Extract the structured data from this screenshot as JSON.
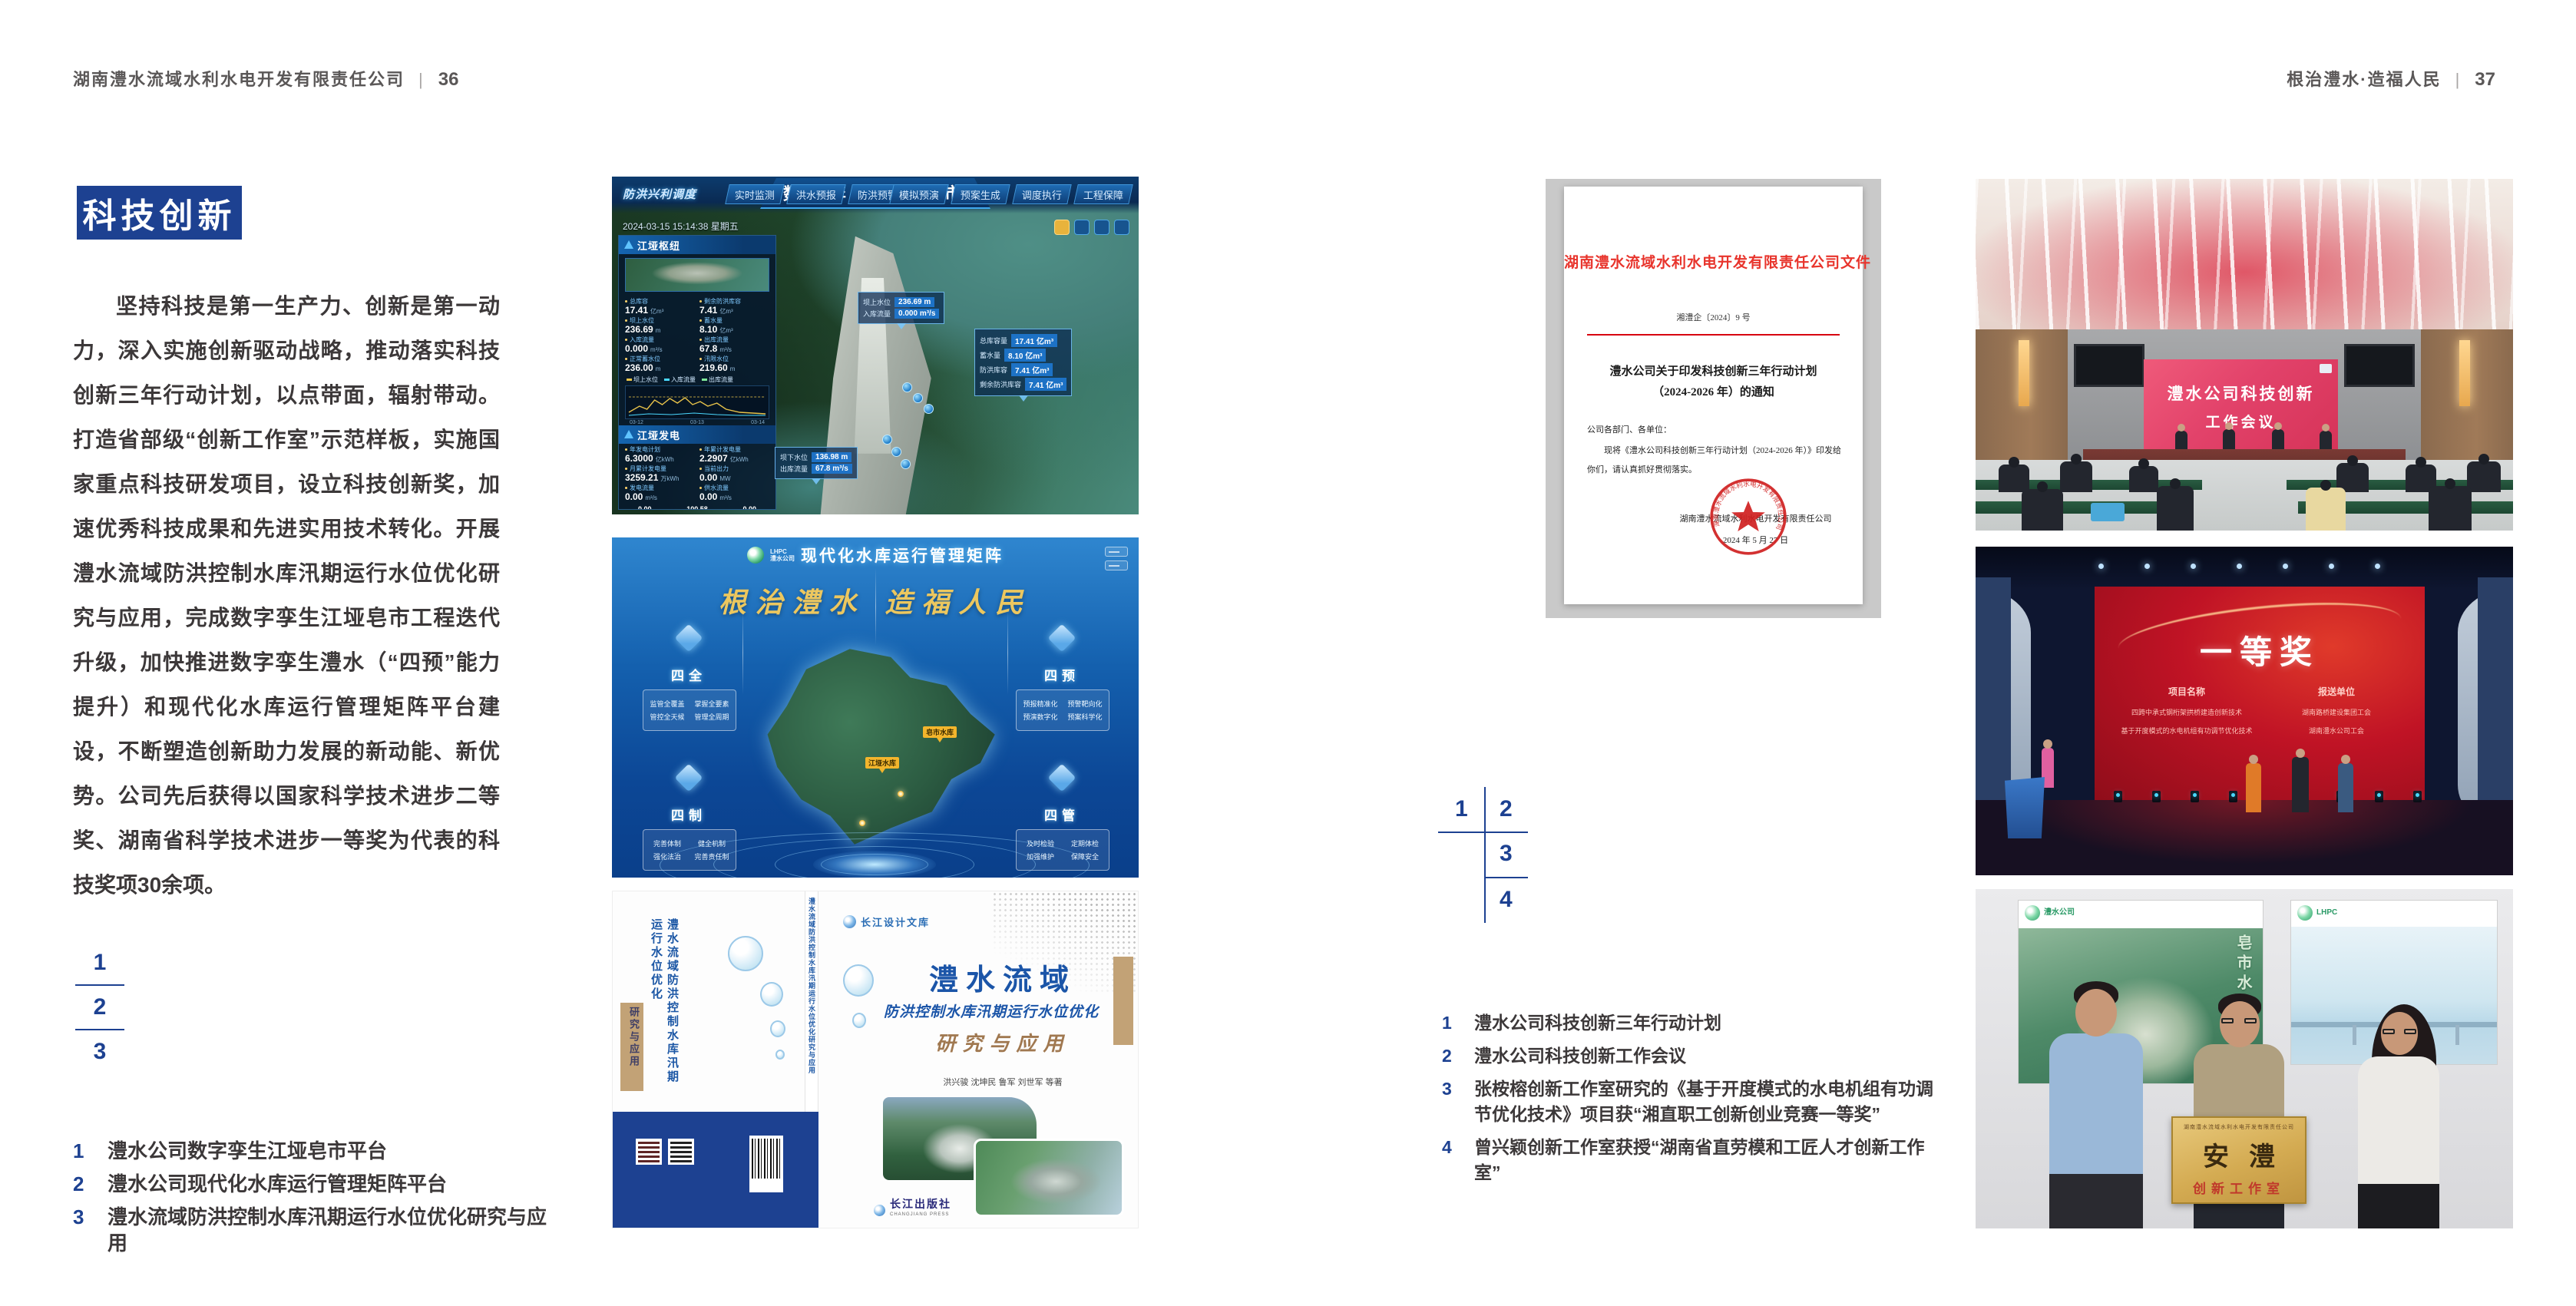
{
  "colors": {
    "brand_blue": "#1d4191",
    "header_gray": "#5a5757",
    "doc_red": "#e60012",
    "book_blue": "#1b55a8",
    "book_tan": "#c2a276",
    "slogan_gold": "#ecc75f",
    "award_red": "#c01325",
    "plaque_gold": "#d4ab52"
  },
  "header_left": {
    "company": "湖南澧水流域水利水电开发有限责任公司",
    "divider": "|",
    "page": "36"
  },
  "header_right": {
    "slogan": "根治澧水·造福人民",
    "divider": "|",
    "page": "37"
  },
  "left": {
    "section_title": "科技创新",
    "paragraph": "坚持科技是第一生产力、创新是第一动力，深入实施创新驱动战略，推动落实科技创新三年行动计划，以点带面，辐射带动。打造省部级“创新工作室”示范样板，实施国家重点科技研发项目，设立科技创新奖，加速优秀科技成果和先进实用技术转化。开展澧水流域防洪控制水库汛期运行水位优化研究与应用，完成数字孪生江垭皂市工程迭代升级，加快推进数字孪生澧水（“四预”能力提升）和现代化水库运行管理矩阵平台建设，不断塑造创新助力发展的新动能、新优势。公司先后获得以国家科学技术进步二等奖、湖南省科学技术进步一等奖为代表的科技奖项30余项。",
    "figure_index": [
      "1",
      "2",
      "3"
    ],
    "captions": [
      {
        "no": "1",
        "text": "澧水公司数字孪生江垭皂市平台"
      },
      {
        "no": "2",
        "text": "澧水公司现代化水库运行管理矩阵平台"
      },
      {
        "no": "3",
        "text": "澧水流域防洪控制水库汛期运行水位优化研究与应用"
      }
    ]
  },
  "right": {
    "figure_index": [
      "1",
      "2",
      "3",
      "4"
    ],
    "captions": [
      {
        "no": "1",
        "text": "澧水公司科技创新三年行动计划"
      },
      {
        "no": "2",
        "text": "澧水公司科技创新工作会议"
      },
      {
        "no": "3",
        "text": "张桉榕创新工作室研究的《基于开度模式的水电机组有功调节优化技术》项目获“湘直职工创新创业竞赛一等奖”"
      },
      {
        "no": "4",
        "text": "曾兴颖创新工作室获授“湖南省直劳模和工匠人才创新工作室”"
      }
    ]
  },
  "figure1": {
    "title": "数字孪生江垭皂市",
    "module_label": "防洪兴利调度",
    "datetime": "2024-03-15 15:14:38 星期五",
    "tabs_left": [
      "实时监测",
      "洪水预报",
      "防洪预警"
    ],
    "tabs_right": [
      "模拟预演",
      "预案生成",
      "调度执行",
      "工程保障"
    ],
    "panel1_title": "江垭枢纽",
    "panel1_stats": [
      {
        "label": "总库容",
        "value": "17.41",
        "unit": "亿m³"
      },
      {
        "label": "剩余防洪库容",
        "value": "7.41",
        "unit": "亿m³"
      },
      {
        "label": "坝上水位",
        "value": "236.69",
        "unit": "m"
      },
      {
        "label": "蓄水量",
        "value": "8.10",
        "unit": "亿m³"
      },
      {
        "label": "入库流量",
        "value": "0.000",
        "unit": "m³/s"
      },
      {
        "label": "出库流量",
        "value": "67.8",
        "unit": "m³/s"
      },
      {
        "label": "正常蓄水位",
        "value": "236.00",
        "unit": "m"
      },
      {
        "label": "汛限水位",
        "value": "219.60",
        "unit": "m"
      }
    ],
    "chart_legend": [
      "坝上水位",
      "入库流量",
      "出库流量"
    ],
    "chart_ticks": [
      "03-12",
      "03-13",
      "03-14"
    ],
    "panel2_title": "江垭发电",
    "panel2_stats": [
      {
        "label": "年发电计划",
        "value": "6.3000",
        "unit": "亿kWh"
      },
      {
        "label": "年累计发电量",
        "value": "2.2907",
        "unit": "亿kWh"
      },
      {
        "label": "月累计发电量",
        "value": "3259.21",
        "unit": "万kWh"
      },
      {
        "label": "当前出力",
        "value": "0.00",
        "unit": "MW"
      },
      {
        "label": "发电流量",
        "value": "0.00",
        "unit": "m³/s"
      },
      {
        "label": "供水流量",
        "value": "0.00",
        "unit": "m³/s"
      }
    ],
    "gauges": [
      {
        "value": "0.00",
        "label": "1#机组"
      },
      {
        "value": "100.58",
        "label": "2#机组"
      },
      {
        "value": "0.00",
        "label": "3#机组"
      }
    ],
    "tagA": [
      {
        "label": "坝上水位",
        "value": "236.69 m"
      },
      {
        "label": "入库流量",
        "value": "0.000 m³/s"
      }
    ],
    "tagB": [
      {
        "label": "总库容量",
        "value": "17.41 亿m³"
      },
      {
        "label": "蓄水量",
        "value": "8.10 亿m³"
      },
      {
        "label": "防洪库容",
        "value": "7.41 亿m³"
      },
      {
        "label": "剩余防洪库容",
        "value": "7.41 亿m³"
      }
    ],
    "tagC": [
      {
        "label": "坝下水位",
        "value": "136.98 m"
      },
      {
        "label": "出库流量",
        "value": "67.8 m³/s"
      }
    ]
  },
  "figure2": {
    "brand_line1": "LHPC",
    "brand_line2": "澧水公司",
    "title": "现代化水库运行管理矩阵",
    "slogan": "根治澧水 造福人民",
    "markers": [
      "皂市水库",
      "江垭水库"
    ],
    "groups": [
      {
        "name": "四全",
        "items": [
          "监管全覆盖",
          "掌握全要素",
          "管控全天候",
          "管理全周期"
        ]
      },
      {
        "name": "四预",
        "items": [
          "预报精准化",
          "预警靶向化",
          "预演数字化",
          "预案科学化"
        ]
      },
      {
        "name": "四制",
        "items": [
          "完善体制",
          "健全机制",
          "强化法治",
          "完善责任制"
        ]
      },
      {
        "name": "四管",
        "items": [
          "及时检验",
          "定期体检",
          "加强维护",
          "保障安全"
        ]
      }
    ]
  },
  "figure3": {
    "series_logo": "长江设计文库",
    "title_main": "澧水流域",
    "title_sub": "防洪控制水库汛期运行水位优化",
    "title_tail": "研究与应用",
    "authors": "洪兴骏  沈坤民  鲁军  刘世军  等著",
    "spine_title": "澧水流域防洪控制水库汛期运行水位优化研究与应用",
    "publisher": "长江出版社",
    "publisher_en": "CHANGJIANG PRESS"
  },
  "document": {
    "header": "湖南澧水流域水利水电开发有限责任公司文件",
    "doc_no": "湘澧企〔2024〕9 号",
    "title_line1": "澧水公司关于印发科技创新三年行动计划",
    "title_line2": "（2024-2026 年）的通知",
    "salutation": "公司各部门、各单位：",
    "body": "现将《澧水公司科技创新三年行动计划（2024-2026 年）》印发给你们，请认真抓好贯彻落实。",
    "signer": "湖南澧水流域水利水电开发有限责任公司",
    "date": "2024 年 5 月 27 日",
    "seal_text": "湖南澧水流域水利水电开发有限责任公司"
  },
  "photo_meeting": {
    "screen_line1": "澧水公司科技创新",
    "screen_line2": "工作会议"
  },
  "photo_award": {
    "screen_title": "一等奖",
    "col_left": "项目名称",
    "col_right": "报送单位",
    "rows_left": [
      "四跨中承式钢桁架拱桥建造创新技术",
      "基于开度模式的水电机组有功调节优化技术"
    ],
    "rows_right": [
      "湖南路桥建设集团工会",
      "湖南澧水公司工会"
    ]
  },
  "photo_group": {
    "plaque_header": "湖南澧水流域水利水电开发有限责任公司",
    "plaque_title": "安澧",
    "plaque_sub": "创新工作室"
  }
}
